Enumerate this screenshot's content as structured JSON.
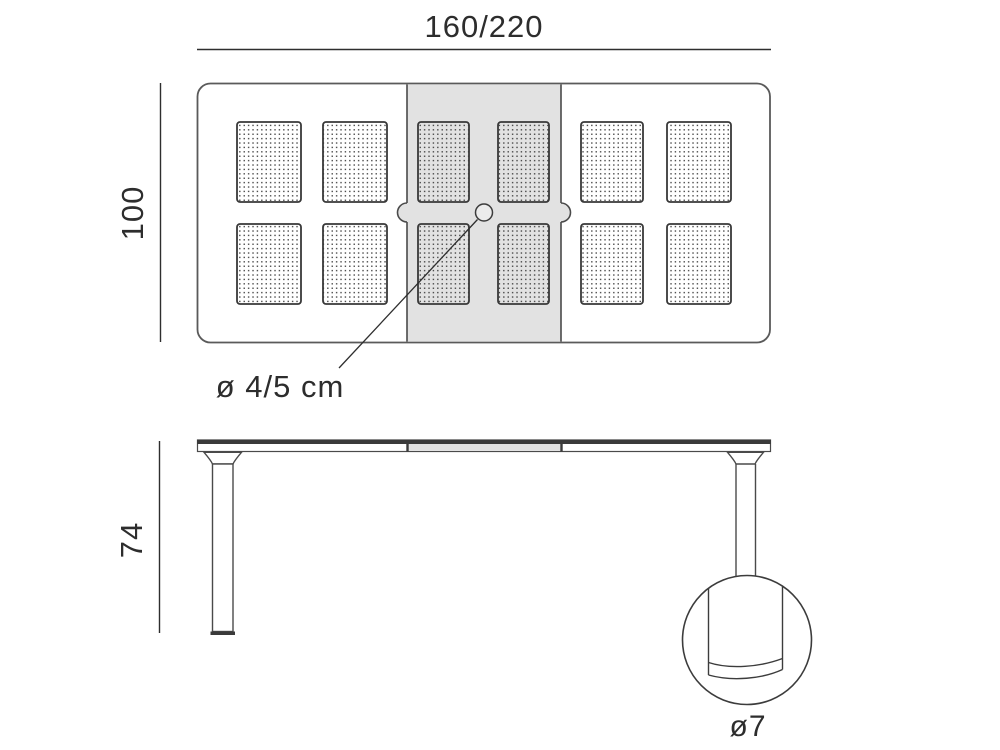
{
  "diagram": {
    "dimensions": {
      "width": "160/220",
      "depth": "100",
      "height": "74",
      "hole_diameter": "ø 4/5 cm",
      "leg_diameter": "ø7"
    },
    "colors": {
      "background": "#ffffff",
      "dimension_line": "#2e2e2e",
      "furniture_outline": "#4a4a4a",
      "extension_leaf_fill": "#e2e2e2",
      "perforation_dot": "#3a3a3a"
    }
  }
}
